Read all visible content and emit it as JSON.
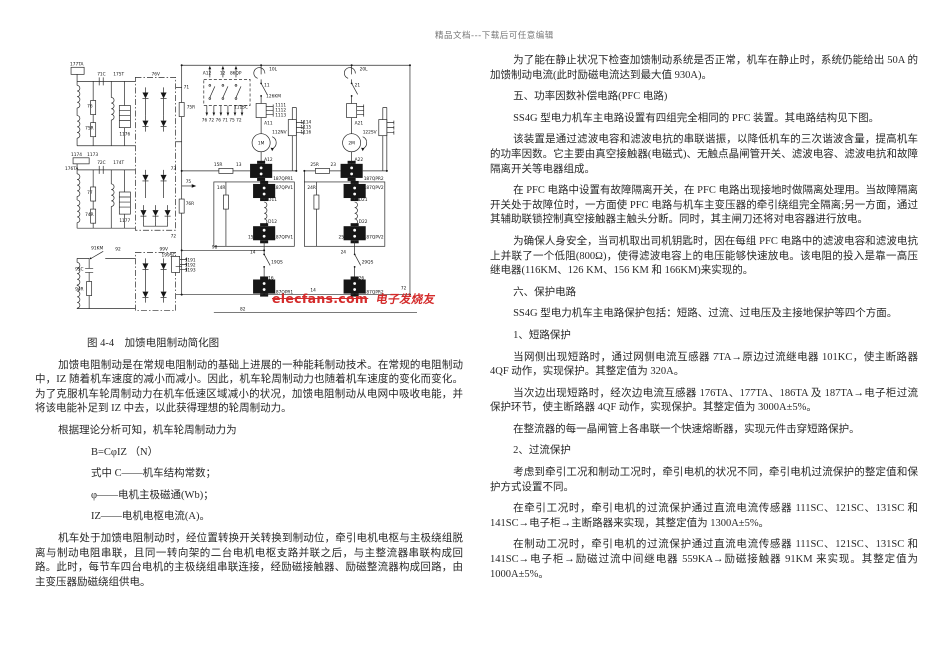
{
  "page": {
    "top_watermark": "精品文档---下载后可任意编辑"
  },
  "diagram": {
    "watermark": {
      "brand": "elecfans-com",
      "cn": "电子发烧友"
    },
    "labels": [
      {
        "t": "177TA",
        "x": 7,
        "y": 8
      },
      {
        "t": "71C",
        "x": 34,
        "y": 18
      },
      {
        "t": "175T",
        "x": 50,
        "y": 18
      },
      {
        "t": "76",
        "x": 24,
        "y": 50
      },
      {
        "t": "75R",
        "x": 22,
        "y": 72
      },
      {
        "t": "1176",
        "x": 56,
        "y": 78
      },
      {
        "t": "1174",
        "x": 8,
        "y": 98
      },
      {
        "t": "1173",
        "x": 24,
        "y": 98
      },
      {
        "t": "176TA",
        "x": 2,
        "y": 112
      },
      {
        "t": "72C",
        "x": 34,
        "y": 106
      },
      {
        "t": "174T",
        "x": 50,
        "y": 106
      },
      {
        "t": "77",
        "x": 24,
        "y": 136
      },
      {
        "t": "74R",
        "x": 22,
        "y": 158
      },
      {
        "t": "1177",
        "x": 56,
        "y": 164
      },
      {
        "t": "92",
        "x": 52,
        "y": 192
      },
      {
        "t": "91KM",
        "x": 28,
        "y": 191
      },
      {
        "t": "93C",
        "x": 12,
        "y": 212
      },
      {
        "t": "94R",
        "x": 12,
        "y": 232
      },
      {
        "t": "199SC",
        "x": 98,
        "y": 198
      },
      {
        "t": "1191",
        "x": 121,
        "y": 203
      },
      {
        "t": "1192",
        "x": 121,
        "y": 208
      },
      {
        "t": "1193",
        "x": 121,
        "y": 213
      },
      {
        "t": "76V",
        "x": 88,
        "y": 18
      },
      {
        "t": "99V",
        "x": 96,
        "y": 192
      },
      {
        "t": "71",
        "x": 120,
        "y": 31
      },
      {
        "t": "75R",
        "x": 123,
        "y": 51
      },
      {
        "t": "73",
        "x": 107,
        "y": 112
      },
      {
        "t": "75",
        "x": 122,
        "y": 125
      },
      {
        "t": "76R",
        "x": 122,
        "y": 147
      },
      {
        "t": "72",
        "x": 107,
        "y": 179
      },
      {
        "t": "A12",
        "x": 139,
        "y": 17
      },
      {
        "t": "12",
        "x": 156,
        "y": 17
      },
      {
        "t": "86QP",
        "x": 166,
        "y": 17
      },
      {
        "t": "76 72 76 71 75 72",
        "x": 138,
        "y": 64
      },
      {
        "t": "10L",
        "x": 205,
        "y": 13
      },
      {
        "t": "11",
        "x": 200,
        "y": 29
      },
      {
        "t": "126KM",
        "x": 202,
        "y": 40
      },
      {
        "t": "111SC",
        "x": 170,
        "y": 51
      },
      {
        "t": "1111",
        "x": 211,
        "y": 49
      },
      {
        "t": "1112",
        "x": 211,
        "y": 54
      },
      {
        "t": "1113",
        "x": 211,
        "y": 59
      },
      {
        "t": "A11",
        "x": 200,
        "y": 67
      },
      {
        "t": "112NV",
        "x": 208,
        "y": 76
      },
      {
        "t": "1M",
        "x": 197,
        "y": 87,
        "a": "middle"
      },
      {
        "t": "A12",
        "x": 200,
        "y": 103
      },
      {
        "t": "187QPR1",
        "x": 209,
        "y": 122
      },
      {
        "t": "15R",
        "x": 150,
        "y": 108
      },
      {
        "t": "13",
        "x": 172,
        "y": 108
      },
      {
        "t": "1114",
        "x": 236,
        "y": 66
      },
      {
        "t": "1115",
        "x": 236,
        "y": 71
      },
      {
        "t": "1116",
        "x": 236,
        "y": 76
      },
      {
        "t": "20L",
        "x": 295,
        "y": 13
      },
      {
        "t": "21",
        "x": 290,
        "y": 29
      },
      {
        "t": "A21",
        "x": 290,
        "y": 67
      },
      {
        "t": "122SV",
        "x": 298,
        "y": 76
      },
      {
        "t": "2M",
        "x": 287,
        "y": 87,
        "a": "middle"
      },
      {
        "t": "A22",
        "x": 290,
        "y": 103
      },
      {
        "t": "187QPR2",
        "x": 299,
        "y": 122
      },
      {
        "t": "25R",
        "x": 246,
        "y": 108
      },
      {
        "t": "23",
        "x": 266,
        "y": 108
      },
      {
        "t": "14R",
        "x": 153,
        "y": 131
      },
      {
        "t": "187QPV1",
        "x": 209,
        "y": 131
      },
      {
        "t": "D11",
        "x": 204,
        "y": 143
      },
      {
        "t": "D12",
        "x": 204,
        "y": 165
      },
      {
        "t": "187QPV1",
        "x": 209,
        "y": 180
      },
      {
        "t": "15",
        "x": 184,
        "y": 180
      },
      {
        "t": "24R",
        "x": 243,
        "y": 131
      },
      {
        "t": "187QPV2",
        "x": 299,
        "y": 131
      },
      {
        "t": "D21",
        "x": 294,
        "y": 143
      },
      {
        "t": "D22",
        "x": 294,
        "y": 165
      },
      {
        "t": "187QPV2",
        "x": 299,
        "y": 180
      },
      {
        "t": "25",
        "x": 274,
        "y": 180
      },
      {
        "t": "14",
        "x": 186,
        "y": 195
      },
      {
        "t": "24",
        "x": 276,
        "y": 195
      },
      {
        "t": "19QS",
        "x": 207,
        "y": 205
      },
      {
        "t": "29QS",
        "x": 297,
        "y": 205
      },
      {
        "t": "16",
        "x": 204,
        "y": 221
      },
      {
        "t": "26",
        "x": 294,
        "y": 221
      },
      {
        "t": "187QPR1",
        "x": 209,
        "y": 235
      },
      {
        "t": "187QPR2",
        "x": 299,
        "y": 235
      },
      {
        "t": "98",
        "x": 148,
        "y": 190
      },
      {
        "t": "14",
        "x": 246,
        "y": 233
      },
      {
        "t": "72",
        "x": 336,
        "y": 231
      },
      {
        "t": "82",
        "x": 176,
        "y": 252
      }
    ]
  },
  "left_column": {
    "items": [
      {
        "s": "caption",
        "t": "图 4-4　加馈电阻制动简化图"
      },
      {
        "s": "para",
        "t": "加馈电阻制动是在常规电阻制动的基础上进展的一种能耗制动技术。在常规的电阻制动中，IZ 随着机车速度的减小而减小。因此，机车轮周制动力也随着机车速度的变化而变化。为了克服机车轮周制动力在机车低速区域减小的状况，加馈电阻制动从电网中吸收电能，并将该电能补足到 IZ 中去，以此获得理想的轮周制动力。"
      },
      {
        "s": "para",
        "t": "根据理论分析可知，机车轮周制动力为"
      },
      {
        "s": "formula",
        "t": "B=CφIZ （N）"
      },
      {
        "s": "formula",
        "t": "式中 C——机车结构常数；"
      },
      {
        "s": "formula",
        "t": "φ——电机主极磁通(Wb)；"
      },
      {
        "s": "formula",
        "t": "IZ——电机电枢电流(A)。"
      },
      {
        "s": "para",
        "t": "机车处于加馈电阻制动时，经位置转换开关转换到制动位，牵引电机电枢与主极绕组脱离与制动电阻串联，且同一转向架的二台电机电枢支路并联之后，与主整流器串联构成回路。此时，每节车四台电机的主极绕组串联连接，经励磁接触器、励磁整流器构成回路，由主变压器励磁绕组供电。"
      }
    ]
  },
  "right_column": {
    "blocks": [
      {
        "s": "para",
        "t": "为了能在静止状况下检查加馈制动系统是否正常，机车在静止时，系统仍能给出 50A 的加馈制动电流(此时励磁电流达到最大值 930A)。"
      },
      {
        "s": "para",
        "t": "五、功率因数补偿电路(PFC 电路)"
      },
      {
        "s": "para",
        "t": "SS4G 型电力机车主电路设置有四组完全相同的 PFC 装置。其电路结构见下图。"
      },
      {
        "s": "para",
        "t": "该装置是通过滤波电容和滤波电抗的串联谐振，以降低机车的三次谐波含量，提高机车的功率因数。它主要由真空接触器(电磁式)、无触点晶闸管开关、滤波电容、滤波电抗和故障隔离开关等电器组成。"
      },
      {
        "s": "para",
        "t": "在 PFC 电路中设置有故障隔离开关，在 PFC 电路出现接地时做隔离处理用。当故障隔离开关处于故障位时，一方面使 PFC 电路与机车主变压器的牵引绕组完全隔离;另一方面，通过其辅助联锁控制真空接触器主触头分断。同时，其主闸刀还将对电容器进行放电。"
      },
      {
        "s": "para",
        "t": "为确保人身安全，当司机取出司机钥匙时，因在每组 PFC 电路中的滤波电容和滤波电抗上并联了一个低阻(800Ω)，使得滤波电容上的电压能够快速放电。该电阻的投入是靠一高压继电器(116KM、126 KM、156 KM 和 166KM)来实现的。"
      },
      {
        "s": "para",
        "t": "六、保护电路"
      },
      {
        "s": "para",
        "t": "SS4G 型电力机车主电路保护包括：短路、过流、过电压及主接地保护等四个方面。"
      },
      {
        "s": "para",
        "t": "1、短路保护"
      },
      {
        "s": "para",
        "t": "当网侧出现短路时，通过网侧电流互感器 7TA→原边过流继电器 101KC，使主断路器 4QF 动作，实现保护。其整定值为 320A。"
      },
      {
        "s": "para",
        "t": "当次边出现短路时，经次边电流互感器 176TA、177TA、186TA 及 187TA→电子柜过流保护环节，使主断路器 4QF 动作，实现保护。其整定值为 3000A±5%。"
      },
      {
        "s": "para",
        "t": "在整流器的每一晶闸管上各串联一个快速熔断器，实现元件击穿短路保护。"
      },
      {
        "s": "para",
        "t": "2、过流保护"
      },
      {
        "s": "para",
        "t": "考虑到牵引工况和制动工况时，牵引电机的状况不同，牵引电机过流保护的整定值和保护方式设置不同。"
      },
      {
        "s": "para",
        "t": "在牵引工况时，牵引电机的过流保护通过直流电流传感器 111SC、121SC、131SC 和 141SC→电子柜→主断路器来实现，其整定值为 1300A±5%。"
      },
      {
        "s": "para",
        "t": "在制动工况时，牵引电机的过流保护通过直流电流传感器 111SC、121SC、131SC 和 141SC→电子柜→励磁过流中间继电器 559KA→励磁接触器 91KM 来实现。其整定值为 1000A±5%。"
      }
    ]
  }
}
